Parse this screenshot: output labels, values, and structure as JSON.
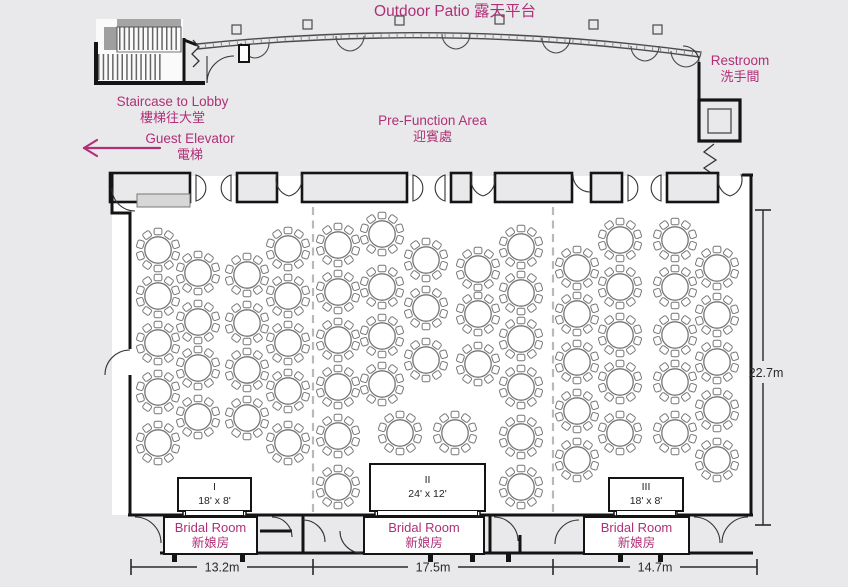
{
  "colors": {
    "accent": "#b03077",
    "wall": "#141414",
    "background": "#e9e8ea",
    "hall_floor": "#ffffff",
    "furniture": "#767676",
    "dimension_text": "#2a2a2a",
    "dashed_divider": "#b9b9b9"
  },
  "labels": {
    "outdoor_patio": "Outdoor Patio 露天平台",
    "staircase": {
      "en": "Staircase to Lobby",
      "zh": "樓梯往大堂"
    },
    "guest_elevator": {
      "en": "Guest Elevator",
      "zh": "電梯"
    },
    "pre_function": {
      "en": "Pre-Function Area",
      "zh": "迎賓處"
    },
    "restroom": {
      "en": "Restroom",
      "zh": "洗手間"
    },
    "bridal_room": {
      "en": "Bridal Room",
      "zh": "新娘房"
    }
  },
  "stages": [
    {
      "numeral": "I",
      "size": "18' x 8'"
    },
    {
      "numeral": "II",
      "size": "24' x 12'"
    },
    {
      "numeral": "III",
      "size": "18' x 8'"
    }
  ],
  "dimensions": {
    "bottom_segments": [
      "13.2m",
      "17.5m",
      "14.7m"
    ],
    "side": "22.7m"
  },
  "tables": {
    "seats_per_table": 10,
    "sections": [
      {
        "name": "I",
        "seats": [
          [
            158,
            250
          ],
          [
            158,
            296
          ],
          [
            158,
            343
          ],
          [
            158,
            392
          ],
          [
            158,
            443
          ],
          [
            198,
            273
          ],
          [
            198,
            322
          ],
          [
            198,
            368
          ],
          [
            198,
            417
          ],
          [
            247,
            275
          ],
          [
            247,
            323
          ],
          [
            247,
            370
          ],
          [
            247,
            418
          ],
          [
            288,
            249
          ],
          [
            288,
            296
          ],
          [
            288,
            343
          ],
          [
            288,
            391
          ],
          [
            288,
            443
          ]
        ]
      },
      {
        "name": "II",
        "seats": [
          [
            338,
            245
          ],
          [
            338,
            292
          ],
          [
            338,
            340
          ],
          [
            338,
            387
          ],
          [
            338,
            436
          ],
          [
            338,
            487
          ],
          [
            382,
            234
          ],
          [
            382,
            287
          ],
          [
            382,
            336
          ],
          [
            382,
            384
          ],
          [
            400,
            433
          ],
          [
            455,
            433
          ],
          [
            426,
            260
          ],
          [
            426,
            308
          ],
          [
            426,
            360
          ],
          [
            478,
            269
          ],
          [
            478,
            314
          ],
          [
            478,
            364
          ],
          [
            521,
            247
          ],
          [
            521,
            293
          ],
          [
            521,
            339
          ],
          [
            521,
            387
          ],
          [
            521,
            437
          ],
          [
            521,
            487
          ]
        ]
      },
      {
        "name": "III",
        "seats": [
          [
            577,
            268
          ],
          [
            577,
            314
          ],
          [
            577,
            362
          ],
          [
            577,
            411
          ],
          [
            577,
            460
          ],
          [
            620,
            240
          ],
          [
            620,
            287
          ],
          [
            620,
            335
          ],
          [
            620,
            382
          ],
          [
            620,
            433
          ],
          [
            675,
            240
          ],
          [
            675,
            287
          ],
          [
            675,
            335
          ],
          [
            675,
            382
          ],
          [
            675,
            433
          ],
          [
            717,
            268
          ],
          [
            717,
            315
          ],
          [
            717,
            362
          ],
          [
            717,
            410
          ],
          [
            717,
            460
          ]
        ]
      }
    ]
  }
}
